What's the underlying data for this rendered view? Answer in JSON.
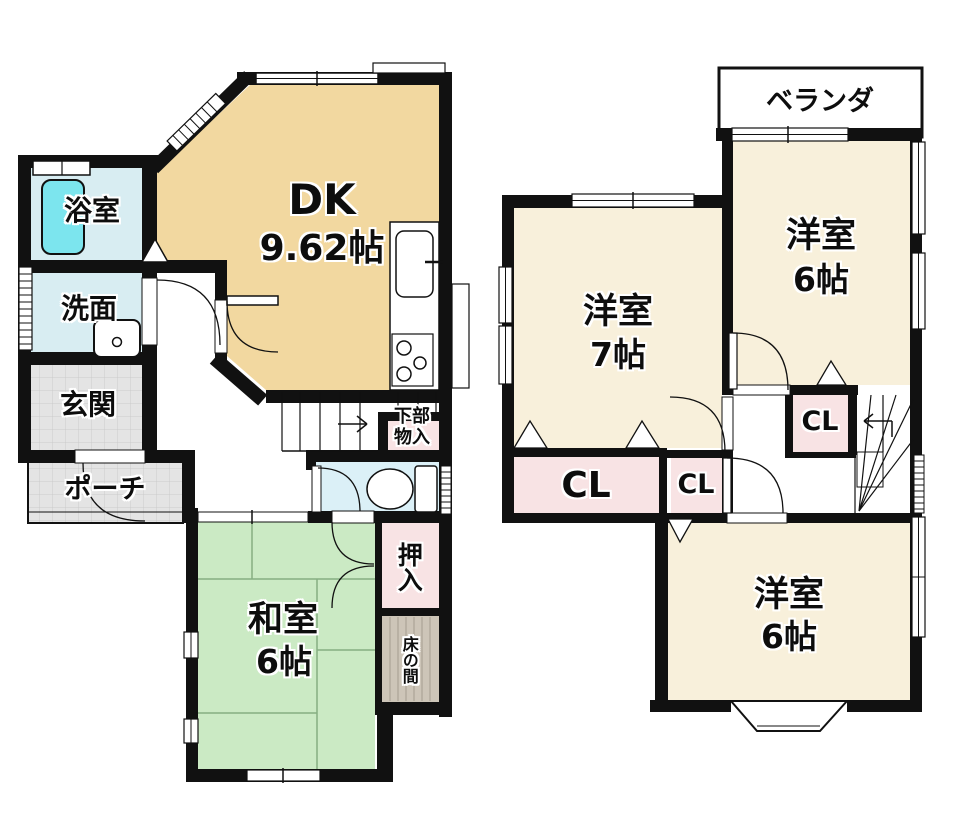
{
  "floor1": {
    "dk": {
      "label": "DK",
      "size": "9.62帖"
    },
    "bath": {
      "label": "浴室"
    },
    "wash": {
      "label": "洗面"
    },
    "genkan": {
      "label": "玄関"
    },
    "porch": {
      "label": "ポーチ"
    },
    "washitsu": {
      "label": "和室",
      "size": "6帖"
    },
    "oshiire": {
      "label": "押入"
    },
    "tokonoma": {
      "label": "床の間"
    },
    "under_stairs_storage": {
      "line1": "下部",
      "line2": "物入"
    }
  },
  "floor2": {
    "veranda": {
      "label": "ベランダ"
    },
    "western7": {
      "label": "洋室",
      "size": "7帖"
    },
    "western6_upper": {
      "label": "洋室",
      "size": "6帖"
    },
    "western6_lower": {
      "label": "洋室",
      "size": "6帖"
    },
    "closet_main": {
      "label": "CL"
    },
    "closet_hall": {
      "label": "CL"
    },
    "closet_upper": {
      "label": "CL"
    }
  },
  "colors": {
    "wall": "#111111",
    "dk_floor": "#F2D8A0",
    "western_floor": "#F8F0DB",
    "tatami_green": "#CBEAC4",
    "bath_blue": "#D8EDF2",
    "bathtub_cyan": "#7CE5EE",
    "toilet_blue": "#DBF0F7",
    "closet_pink": "#F8E3E4",
    "tokonoma_tan": "#CDC5B8",
    "tile_gray": "#E4E4E4"
  }
}
